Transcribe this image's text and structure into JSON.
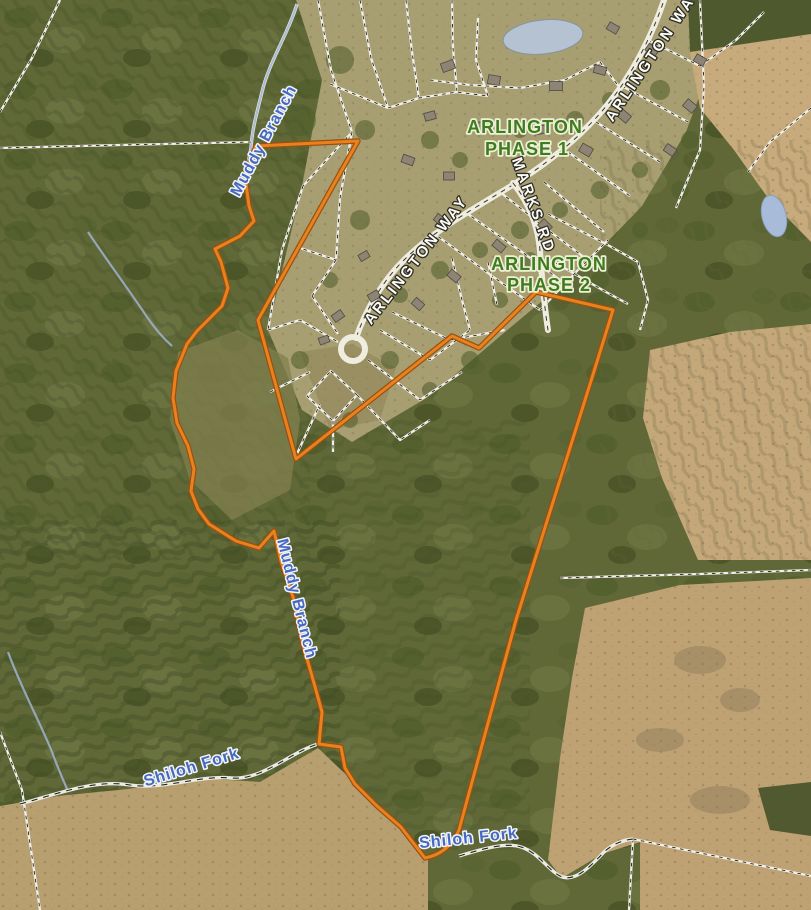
{
  "map": {
    "region_labels": {
      "phase1_line1": "ARLINGTON",
      "phase1_line2": "PHASE 1",
      "phase2_line1": "ARLINGTON",
      "phase2_line2": "PHASE 2"
    },
    "road_labels": {
      "arlington_way_central": "ARLINGTON WAY",
      "arlington_way_northeast": "ARLINGTON WAY",
      "marks_rd": "MARKS RD"
    },
    "water_labels": {
      "muddy_branch_upper": "Muddy Branch",
      "muddy_branch_lower": "Muddy Branch",
      "shiloh_fork_west": "Shiloh Fork",
      "shiloh_fork_east": "Shiloh Fork"
    },
    "colors": {
      "parcel_outline": "#e8821e",
      "parcel_outline_edge": "#9a4f10",
      "subdivision_label_green": "#3e7c1f",
      "water_label_blue": "#4668be",
      "road_label_white": "#fdfdf8",
      "pond_blue": "#b5c2d1"
    },
    "geometry": {
      "parcel_boundary_path": "M 256,146 L 358,141 L 258,320 L 296,459 L 452,336 L 479,348 L 536,292 L 613,310 L 591,381 L 516,620 L 459,830 C 452,846 441,855 425,858 L 401,827 L 377,806 L 355,784 L 345,768 L 341,747 L 319,744 L 322,712 L 312,676 L 303,645 L 293,597 L 281,561 L 274,531 L 259,548 L 236,541 L 209,524 L 198,509 L 191,491 L 194,469 L 188,446 L 177,423 L 173,398 L 176,371 L 187,344 L 197,331 L 222,306 L 228,288 L 221,262 L 215,249 L 240,236 L 254,221 L 249,206 L 246,184 L 250,161 Z",
      "arlington_way_path": "M 666,-6 C 654,32 634,72 608,104 C 582,136 550,162 511,186 C 470,211 433,231 403,261 C 381,283 365,312 356,338",
      "marks_rd_path": "M 513,183 C 529,203 538,225 540,251 C 542,279 544,304 548,330",
      "muddy_branch_creek_path": "M 297,4 C 288,34 269,62 262,92 C 257,112 252,130 251,148 C 247,168 244,186 249,205",
      "shiloh_fork_west_path": "M 20,804 C 58,794 94,779 130,785 C 164,790 199,775 231,778 C 261,781 289,753 318,744",
      "shiloh_fork_east_path": "M 459,856 C 482,849 506,842 521,847 C 539,853 547,869 560,876 C 574,883 589,868 604,852 C 614,843 624,840 633,839",
      "tributary_southwest_path": "M 8,652 C 22,690 40,722 52,752 C 58,768 63,780 68,791",
      "tributary_northwest_path": "M 88,232 C 108,262 129,290 147,317 C 156,330 164,339 172,346"
    },
    "boundary_lines": [
      "M0,148 L120,145 L252,142",
      "M0,112 L32,58 L60,0",
      "M560,578 L700,574 L811,570",
      "M0,732 L22,790 L40,910",
      "M811,108 L770,142 L748,172",
      "M633,839 L811,876",
      "M633,839 L629,910"
    ],
    "lot_lines": [
      "M318,0 L331,70 L352,132 L303,186",
      "M352,132 L340,198 L336,260 L300,248",
      "M336,260 L312,296",
      "M360,0 L371,58 L388,108",
      "M406,0 L412,52 L419,98",
      "M452,0 L453,48 L457,92",
      "M388,108 L419,98 L457,92 L488,96",
      "M330,84 L388,108",
      "M488,96 L476,60 L478,18",
      "M430,80 L470,85 L520,88 L565,80 L600,62",
      "M600,62 L620,88",
      "M648,40 L700,66",
      "M622,86 L688,122",
      "M596,122 L660,162",
      "M568,152 L630,196",
      "M544,182 L604,232",
      "M700,0 L704,86 L700,150 L676,208",
      "M700,66 L736,40 L764,12",
      "M548,214 L606,244 L638,262",
      "M554,262 L606,292 L628,304",
      "M638,262 L648,300 L640,330",
      "M303,186 L282,250 L268,330",
      "M268,330 L300,320 L338,342",
      "M312,296 L338,334",
      "M270,392 L310,372",
      "M296,456 L320,404",
      "M331,371 L357,395 L333,421 L307,396 Z",
      "M333,421 L333,452",
      "M357,395 L400,440 L430,420",
      "M368,360 L420,400 L462,372",
      "M380,330 L430,360 L470,330",
      "M392,312 L450,340 L505,330",
      "M432,232 L492,276 L540,310",
      "M465,212 L522,252 L560,280",
      "M500,192 L548,230 L585,258",
      "M540,310 L578,270 L608,240",
      "M452,258 L462,300 L470,330",
      "M488,262 L497,305"
    ],
    "houses": [
      [
        448,
        66,
        13,
        9,
        -20
      ],
      [
        494,
        80,
        12,
        9,
        10
      ],
      [
        556,
        86,
        13,
        9,
        0
      ],
      [
        600,
        70,
        12,
        8,
        15
      ],
      [
        624,
        116,
        12,
        9,
        40
      ],
      [
        586,
        150,
        12,
        9,
        30
      ],
      [
        540,
        130,
        12,
        8,
        -10
      ],
      [
        480,
        126,
        12,
        8,
        0
      ],
      [
        430,
        116,
        11,
        8,
        -15
      ],
      [
        408,
        160,
        12,
        8,
        20
      ],
      [
        449,
        176,
        11,
        8,
        0
      ],
      [
        613,
        28,
        11,
        8,
        30
      ],
      [
        652,
        50,
        12,
        8,
        35
      ],
      [
        690,
        106,
        12,
        9,
        40
      ],
      [
        670,
        150,
        11,
        8,
        35
      ],
      [
        545,
        226,
        12,
        9,
        45
      ],
      [
        499,
        246,
        12,
        8,
        40
      ],
      [
        454,
        276,
        12,
        8,
        40
      ],
      [
        418,
        304,
        11,
        8,
        42
      ],
      [
        374,
        296,
        11,
        8,
        -30
      ],
      [
        338,
        316,
        11,
        8,
        -35
      ],
      [
        440,
        220,
        11,
        8,
        40
      ],
      [
        364,
        256,
        10,
        7,
        -30
      ],
      [
        324,
        340,
        10,
        7,
        -20
      ],
      [
        700,
        60,
        11,
        8,
        30
      ]
    ],
    "trees": [
      [
        340,
        60,
        14
      ],
      [
        300,
        120,
        16
      ],
      [
        365,
        130,
        10
      ],
      [
        430,
        140,
        9
      ],
      [
        520,
        130,
        8
      ],
      [
        575,
        120,
        9
      ],
      [
        610,
        100,
        8
      ],
      [
        660,
        90,
        10
      ],
      [
        690,
        140,
        9
      ],
      [
        640,
        170,
        8
      ],
      [
        600,
        190,
        9
      ],
      [
        560,
        210,
        8
      ],
      [
        520,
        230,
        9
      ],
      [
        480,
        250,
        8
      ],
      [
        440,
        270,
        9
      ],
      [
        400,
        295,
        8
      ],
      [
        560,
        300,
        10
      ],
      [
        600,
        280,
        9
      ],
      [
        640,
        230,
        8
      ],
      [
        680,
        190,
        9
      ],
      [
        360,
        220,
        10
      ],
      [
        330,
        280,
        8
      ],
      [
        390,
        360,
        9
      ],
      [
        430,
        390,
        8
      ],
      [
        470,
        360,
        9
      ],
      [
        350,
        420,
        8
      ],
      [
        300,
        360,
        9
      ],
      [
        460,
        160,
        8
      ],
      [
        500,
        300,
        8
      ],
      [
        530,
        260,
        8
      ]
    ]
  }
}
